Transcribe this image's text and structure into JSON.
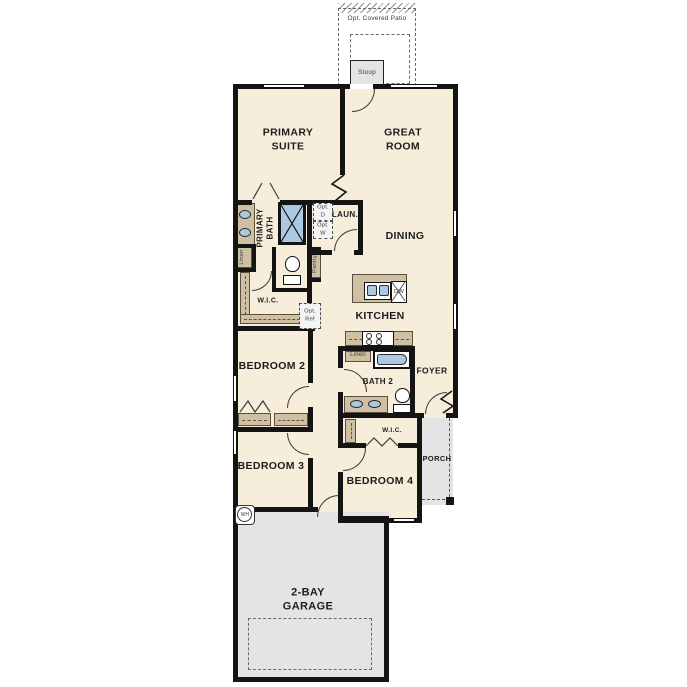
{
  "colors": {
    "floor": "#f6edda",
    "outdoor_concrete": "#e4e4e4",
    "wall": "#141414",
    "cabinet_tan": "#cfc0a3",
    "fixture_blue": "#abc9e3"
  },
  "outdoor": {
    "patio": "Opt. Covered Patio",
    "stoop": "Stoop",
    "porch": "PORCH",
    "garage": "2-BAY\nGARAGE"
  },
  "rooms": {
    "primary_suite": "PRIMARY\nSUITE",
    "great_room": "GREAT\nROOM",
    "dining": "DINING",
    "kitchen": "KITCHEN",
    "laundry": "LAUN.",
    "primary_bath": "PRIMARY\nBATH",
    "wic_primary": "W.I.C.",
    "bedroom2": "BEDROOM 2",
    "bath2": "BATH 2",
    "foyer": "FOYER",
    "bedroom3": "BEDROOM 3",
    "wic_bedroom4": "W.I.C.",
    "bedroom4": "BEDROOM 4"
  },
  "features": {
    "linen_primary": "Linen",
    "pantry": "Pantry",
    "opt_dryer": "Opt.\nD",
    "opt_washer": "Opt.\nW",
    "opt_ref": "Opt.\nRef",
    "dishwasher": "DW",
    "linen_bath2": "Linen",
    "water_heater": "WH"
  }
}
